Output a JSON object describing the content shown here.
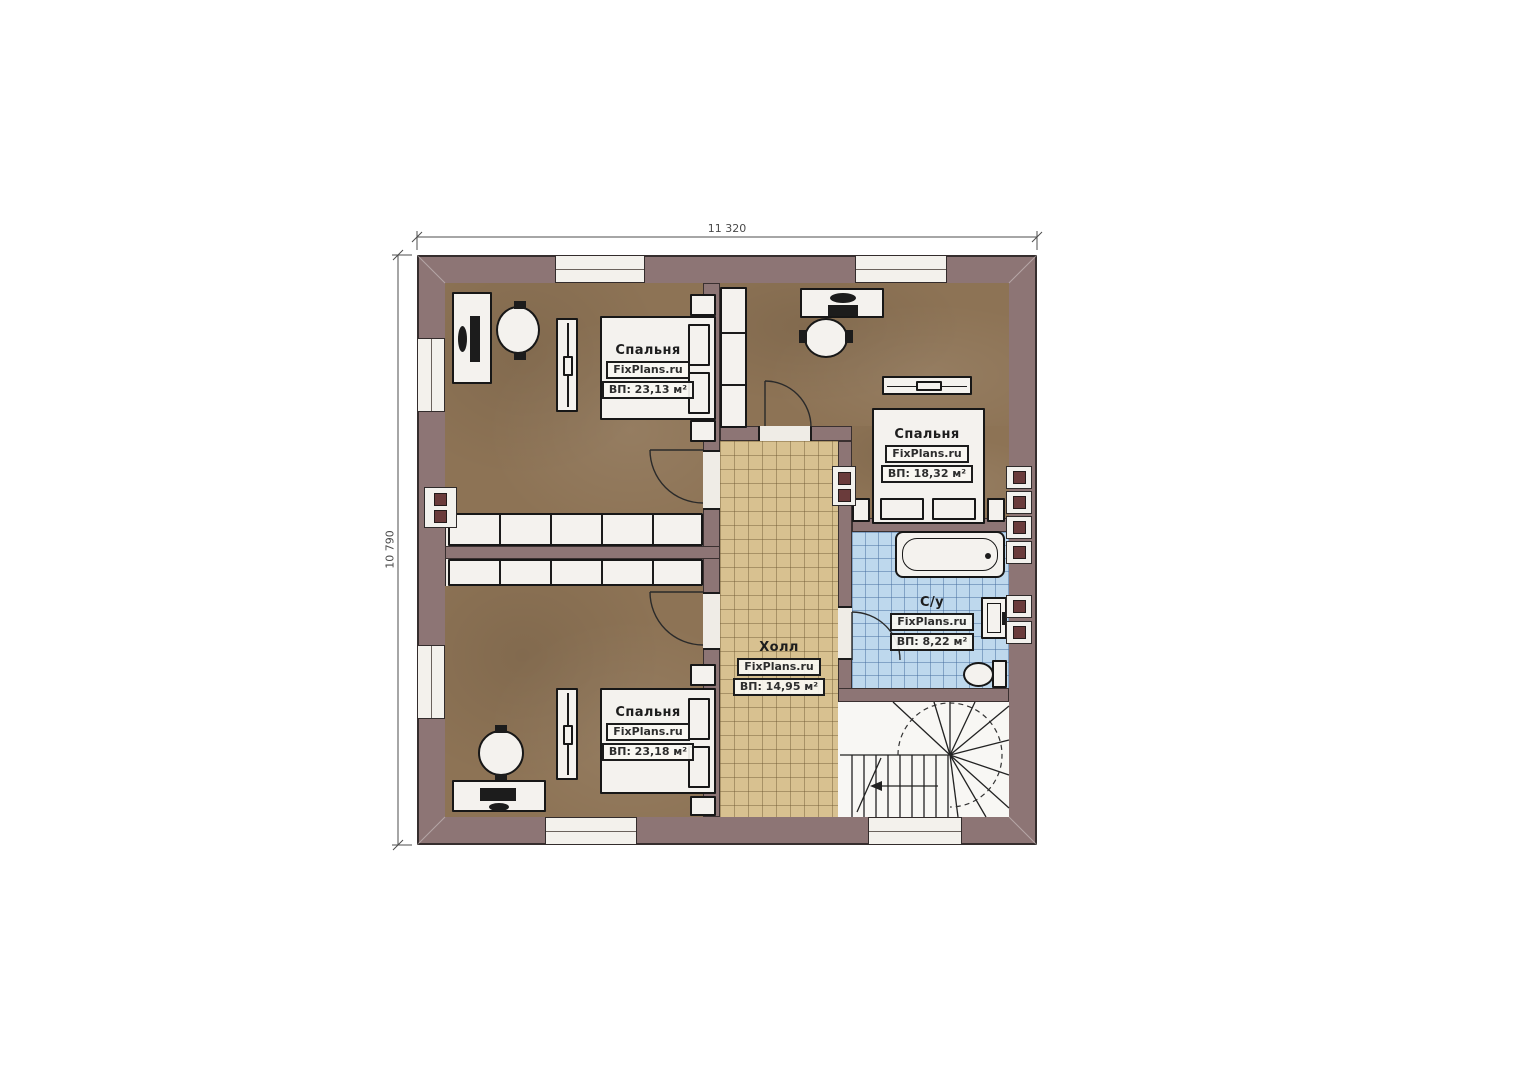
{
  "plan": {
    "title_semantic": "second-floor plan",
    "dimensions": {
      "width_label": "11 320",
      "height_label": "10 790"
    },
    "watermark": "FixPlans.ru",
    "rooms": [
      {
        "name": "Спальня",
        "watermark": "FixPlans.ru",
        "area": "ВП: 23,13 м²"
      },
      {
        "name": "Спальня",
        "watermark": "FixPlans.ru",
        "area": "ВП: 18,32 м²"
      },
      {
        "name": "Спальня",
        "watermark": "FixPlans.ru",
        "area": "ВП: 23,18 м²"
      },
      {
        "name": "Холл",
        "watermark": "FixPlans.ru",
        "area": "ВП: 14,95 м²"
      },
      {
        "name": "С/у",
        "watermark": "FixPlans.ru",
        "area": "ВП: 8,22 м²"
      }
    ],
    "colors": {
      "wall": "#8d7575",
      "bedroom_floor": "#8d7355",
      "hall_floor": "#d8c190",
      "bath_floor": "#bed8ed",
      "linework": "#1b1b1b",
      "vent": "#6a3b3b"
    }
  }
}
